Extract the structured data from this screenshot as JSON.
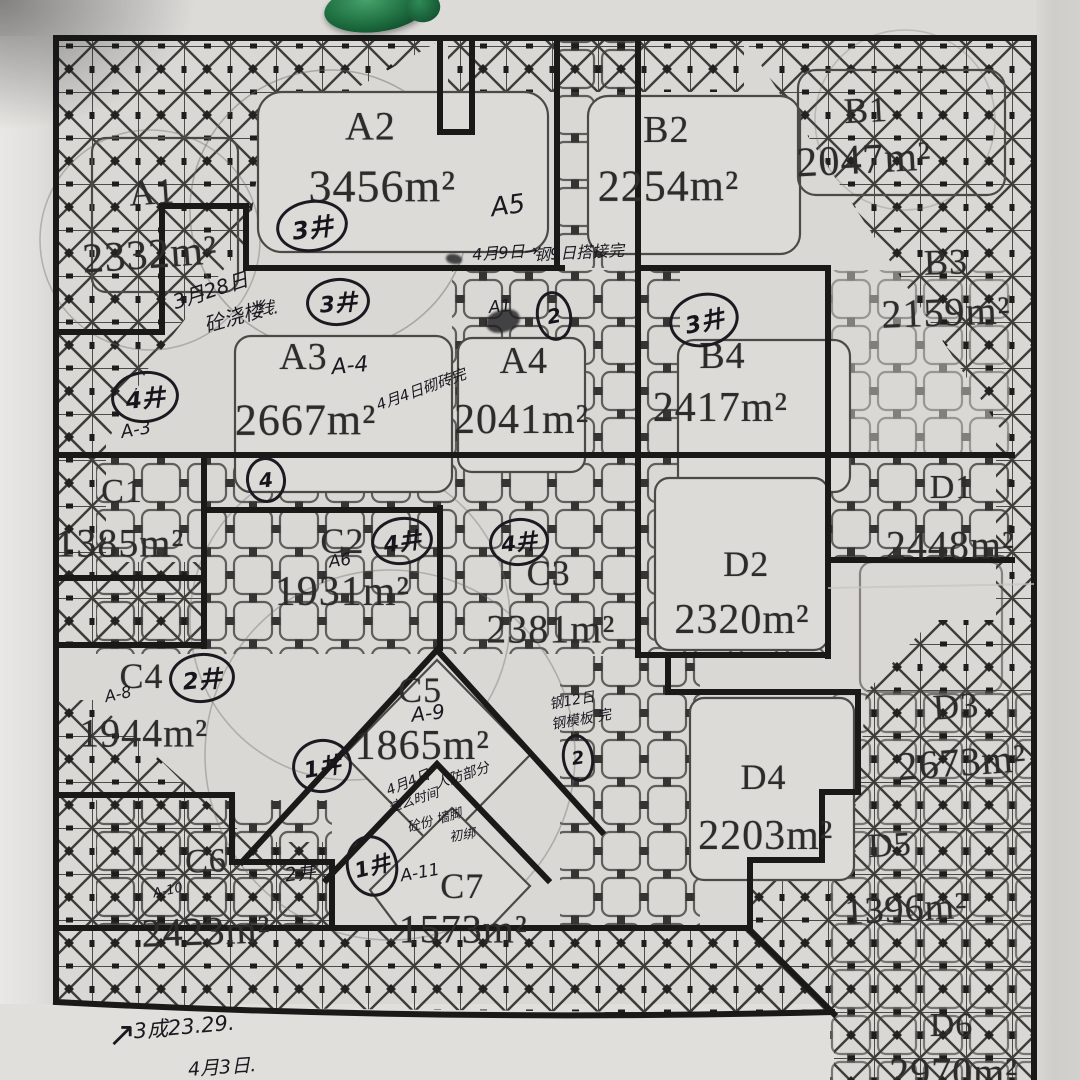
{
  "scene": {
    "description": "Photographed hand-annotated construction zoning site plan",
    "paper_color": "#d9d8d5",
    "ink_color": "#1a1a20",
    "green_object": "green-clip"
  },
  "zones": [
    {
      "id": "A1",
      "label": "A1",
      "area": "2332m²",
      "lx": 14.1,
      "ly": 17.8,
      "ls": 36,
      "ax": 13.9,
      "ay": 23.6,
      "as": 42,
      "rot": -4
    },
    {
      "id": "A2",
      "label": "A2",
      "area": "3456m²",
      "lx": 34.3,
      "ly": 11.7,
      "ls": 40,
      "ax": 35.4,
      "ay": 17.2,
      "as": 46,
      "rot": 0
    },
    {
      "id": "B2",
      "label": "B2",
      "area": "2254m²",
      "lx": 61.7,
      "ly": 12.0,
      "ls": 38,
      "ax": 61.9,
      "ay": 17.2,
      "as": 44,
      "rot": 0
    },
    {
      "id": "B1",
      "label": "B1",
      "area": "2047m²",
      "lx": 80.2,
      "ly": 10.2,
      "ls": 36,
      "ax": 80.0,
      "ay": 14.8,
      "as": 42,
      "rot": -3
    },
    {
      "id": "B3",
      "label": "B3",
      "area": "2159m²",
      "lx": 87.6,
      "ly": 24.3,
      "ls": 36,
      "ax": 87.6,
      "ay": 28.9,
      "as": 40,
      "rot": -2
    },
    {
      "id": "A3",
      "label": "A3",
      "area": "2667m²",
      "lx": 28.1,
      "ly": 33.1,
      "ls": 38,
      "ax": 28.3,
      "ay": 38.9,
      "as": 44,
      "rot": 0
    },
    {
      "id": "A4",
      "label": "A4",
      "area": "2041m²",
      "lx": 48.5,
      "ly": 33.4,
      "ls": 38,
      "ax": 48.3,
      "ay": 38.9,
      "as": 42,
      "rot": 0
    },
    {
      "id": "B4",
      "label": "B4",
      "area": "2417m²",
      "lx": 66.9,
      "ly": 33.0,
      "ls": 38,
      "ax": 66.7,
      "ay": 37.8,
      "as": 42,
      "rot": 0
    },
    {
      "id": "C1",
      "label": "C1",
      "area": "1385m²",
      "lx": 11.3,
      "ly": 45.6,
      "ls": 34,
      "ax": 11.1,
      "ay": 50.3,
      "as": 40,
      "rot": 0
    },
    {
      "id": "C2",
      "label": "C2",
      "area": "1931m²",
      "lx": 31.7,
      "ly": 50.1,
      "ls": 36,
      "ax": 31.7,
      "ay": 54.8,
      "as": 42,
      "rot": 0
    },
    {
      "id": "C3",
      "label": "C3",
      "area": "2381m²",
      "lx": 50.8,
      "ly": 53.1,
      "ls": 36,
      "ax": 51.0,
      "ay": 58.2,
      "as": 40,
      "rot": 0
    },
    {
      "id": "D2",
      "label": "D2",
      "area": "2320m²",
      "lx": 69.1,
      "ly": 52.2,
      "ls": 36,
      "ax": 68.7,
      "ay": 57.4,
      "as": 42,
      "rot": 0
    },
    {
      "id": "D1",
      "label": "D1",
      "area": "2448m²",
      "lx": 88.1,
      "ly": 45.2,
      "ls": 34,
      "ax": 88.0,
      "ay": 50.5,
      "as": 40,
      "rot": 0
    },
    {
      "id": "C4",
      "label": "C4",
      "area": "1944m²",
      "lx": 13.1,
      "ly": 62.6,
      "ls": 36,
      "ax": 13.3,
      "ay": 67.9,
      "as": 40,
      "rot": 0
    },
    {
      "id": "C5",
      "label": "C5",
      "area": "1865m²",
      "lx": 38.9,
      "ly": 63.9,
      "ls": 36,
      "ax": 39.1,
      "ay": 69.1,
      "as": 42,
      "rot": 0
    },
    {
      "id": "D3",
      "label": "D3",
      "area": "2673m²",
      "lx": 88.5,
      "ly": 65.4,
      "ls": 36,
      "ax": 89.1,
      "ay": 70.6,
      "as": 40,
      "rot": -4
    },
    {
      "id": "D4",
      "label": "D4",
      "area": "2203m²",
      "lx": 70.7,
      "ly": 71.9,
      "ls": 36,
      "ax": 70.9,
      "ay": 77.4,
      "as": 42,
      "rot": 0
    },
    {
      "id": "D5",
      "label": "D5",
      "area": "1396m²",
      "lx": 82.4,
      "ly": 78.3,
      "ls": 34,
      "ax": 83.9,
      "ay": 84.2,
      "as": 38,
      "rot": -3
    },
    {
      "id": "C6",
      "label": "C6",
      "area": "2423m²",
      "lx": 19.1,
      "ly": 79.8,
      "ls": 34,
      "ax": 19.1,
      "ay": 86.2,
      "as": 40,
      "rot": -2
    },
    {
      "id": "C7",
      "label": "C7",
      "area": "1573m²",
      "lx": 42.8,
      "ly": 82.0,
      "ls": 36,
      "ax": 42.9,
      "ay": 86.0,
      "as": 40,
      "rot": 0
    },
    {
      "id": "D6",
      "label": "D6",
      "area": "2970m²",
      "lx": 88.1,
      "ly": 95.0,
      "ls": 34,
      "ax": 88.3,
      "ay": 99.3,
      "as": 40,
      "rot": 0
    }
  ],
  "well_markers": [
    {
      "text": "3井",
      "x": 28.9,
      "y": 20.9,
      "w": 66,
      "h": 46,
      "rot": -8,
      "fs": 24
    },
    {
      "text": "3井",
      "x": 31.3,
      "y": 28.0,
      "w": 58,
      "h": 42,
      "rot": -5,
      "fs": 22
    },
    {
      "text": "3井",
      "x": 65.2,
      "y": 29.6,
      "w": 64,
      "h": 48,
      "rot": -12,
      "fs": 23
    },
    {
      "text": "4井",
      "x": 13.4,
      "y": 36.8,
      "w": 62,
      "h": 46,
      "rot": -6,
      "fs": 23
    },
    {
      "text": "4井",
      "x": 37.2,
      "y": 50.1,
      "w": 56,
      "h": 42,
      "rot": -8,
      "fs": 22
    },
    {
      "text": "4井",
      "x": 48.1,
      "y": 50.2,
      "w": 54,
      "h": 42,
      "rot": -6,
      "fs": 21
    },
    {
      "text": "2井",
      "x": 18.7,
      "y": 62.8,
      "w": 60,
      "h": 44,
      "rot": -5,
      "fs": 23
    },
    {
      "text": "1井",
      "x": 29.8,
      "y": 70.9,
      "w": 54,
      "h": 48,
      "rot": -10,
      "fs": 22
    },
    {
      "text": "1井",
      "x": 34.4,
      "y": 80.2,
      "w": 46,
      "h": 56,
      "rot": -14,
      "fs": 21
    },
    {
      "text": "4",
      "x": 24.6,
      "y": 44.4,
      "w": 34,
      "h": 40,
      "rot": -6,
      "fs": 20
    },
    {
      "text": "2",
      "x": 51.3,
      "y": 29.3,
      "w": 30,
      "h": 44,
      "rot": -10,
      "fs": 20
    },
    {
      "text": "2",
      "x": 53.5,
      "y": 70.2,
      "w": 26,
      "h": 42,
      "rot": -8,
      "fs": 18
    }
  ],
  "handwritten_notes": [
    {
      "text": "A5",
      "x": 47.0,
      "y": 19.1,
      "fs": 26,
      "rot": -8
    },
    {
      "text": "3月28日",
      "x": 19.4,
      "y": 26.8,
      "fs": 20,
      "rot": -18
    },
    {
      "text": "砼浇楼",
      "x": 21.6,
      "y": 29.3,
      "fs": 20,
      "rot": -16
    },
    {
      "text": "线.",
      "x": 24.8,
      "y": 28.3,
      "fs": 17,
      "rot": 0
    },
    {
      "text": "A1",
      "x": 46.3,
      "y": 28.4,
      "fs": 17,
      "rot": -5
    },
    {
      "text": "A-4",
      "x": 32.4,
      "y": 33.9,
      "fs": 22,
      "rot": -5
    },
    {
      "text": "4月4日砌砖完",
      "x": 39.0,
      "y": 36.0,
      "fs": 15,
      "rot": -20
    },
    {
      "text": "4月9日→",
      "x": 46.8,
      "y": 23.2,
      "fs": 16,
      "rot": -4
    },
    {
      "text": "钢9日搭接完",
      "x": 53.6,
      "y": 23.2,
      "fs": 16,
      "rot": -3
    },
    {
      "text": "A-3",
      "x": 12.6,
      "y": 39.8,
      "fs": 18,
      "rot": -10
    },
    {
      "text": "A6",
      "x": 31.5,
      "y": 51.9,
      "fs": 17,
      "rot": -8
    },
    {
      "text": "A-8",
      "x": 10.9,
      "y": 64.3,
      "fs": 16,
      "rot": -12
    },
    {
      "text": "A-9",
      "x": 39.6,
      "y": 66.0,
      "fs": 20,
      "rot": -6
    },
    {
      "text": "4月4日",
      "x": 37.8,
      "y": 72.4,
      "fs": 14,
      "rot": -22
    },
    {
      "text": "人防部分",
      "x": 42.8,
      "y": 71.8,
      "fs": 14,
      "rot": -18
    },
    {
      "text": "这么时间",
      "x": 38.2,
      "y": 74.0,
      "fs": 13,
      "rot": -18
    },
    {
      "text": "砼份 墙脚",
      "x": 40.2,
      "y": 75.8,
      "fs": 13,
      "rot": -16
    },
    {
      "text": "初绑",
      "x": 42.8,
      "y": 77.2,
      "fs": 13,
      "rot": -10
    },
    {
      "text": "钢12日",
      "x": 53.0,
      "y": 64.8,
      "fs": 14,
      "rot": -10
    },
    {
      "text": "钢模板 完",
      "x": 53.8,
      "y": 66.6,
      "fs": 14,
      "rot": -10
    },
    {
      "text": "2井",
      "x": 27.8,
      "y": 80.7,
      "fs": 19,
      "rot": -8
    },
    {
      "text": "A-10",
      "x": 15.6,
      "y": 82.5,
      "fs": 13,
      "rot": -12
    },
    {
      "text": "A-11",
      "x": 38.9,
      "y": 80.8,
      "fs": 17,
      "rot": -10
    },
    {
      "text": "↗",
      "x": 11.3,
      "y": 95.8,
      "fs": 34,
      "rot": 0
    },
    {
      "text": "3成23.29.",
      "x": 17.0,
      "y": 95.0,
      "fs": 21,
      "rot": -5
    },
    {
      "text": "4月3日.",
      "x": 20.6,
      "y": 98.7,
      "fs": 19,
      "rot": -4
    }
  ],
  "ink_smudges": [
    {
      "x": 46.6,
      "y": 29.7,
      "w": 34,
      "h": 22,
      "rot": -15
    },
    {
      "x": 42.0,
      "y": 24.0,
      "w": 16,
      "h": 10,
      "rot": 10
    }
  ]
}
